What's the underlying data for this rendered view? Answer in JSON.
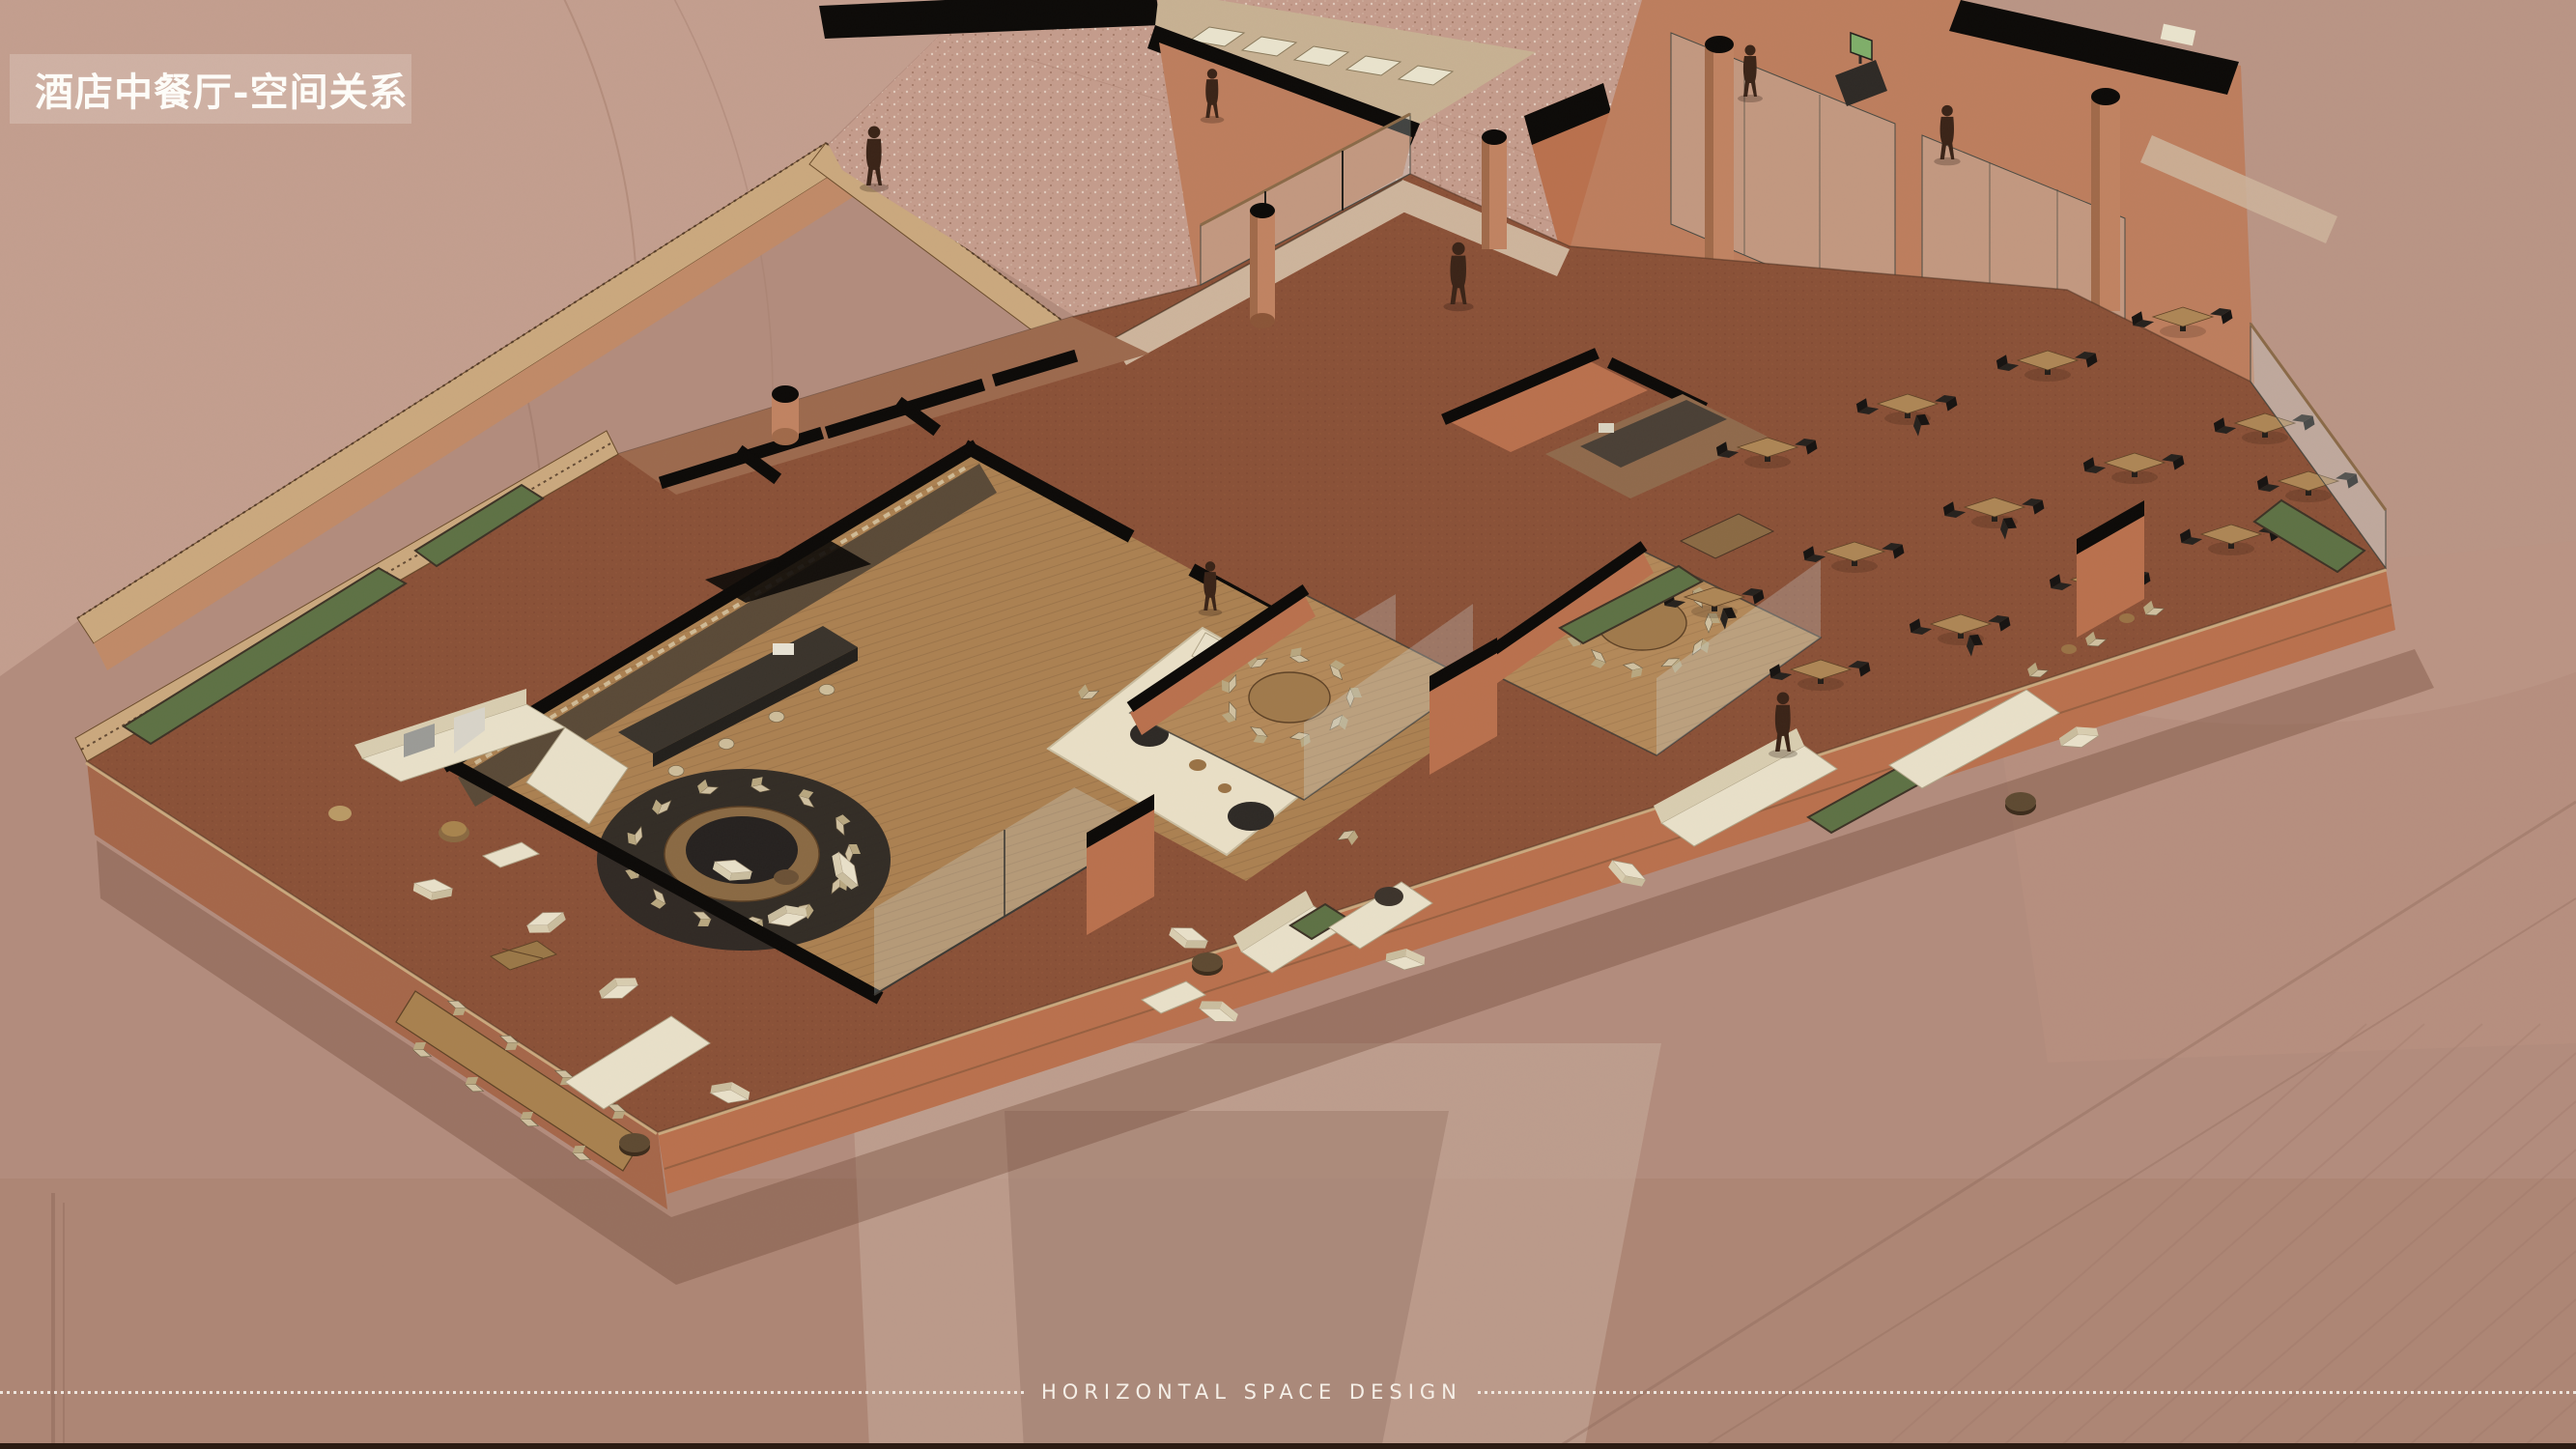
{
  "slide": {
    "title": "酒店中餐厅-空间关系",
    "footer": "HORIZONTAL SPACE DESIGN"
  },
  "colors": {
    "background": "#b28c7d",
    "title_band": "rgba(242,231,223,0.26)",
    "title_text": "#fdfcf8",
    "footer_text": "#f5efe7",
    "terracotta_wall": "#bd7e5e",
    "brick_wall": "#b9714e",
    "cut_wall": "#0c0a08",
    "carpet": "#8a5138",
    "wood_floor": "#ab8152",
    "wood_coping": "#caa87e",
    "cream": "#e8e0c9",
    "planter_green": "#5e7245",
    "courtyard_paving": "#c49c8c",
    "glass": "rgba(210,220,218,0.28)",
    "figure": "#3a2418"
  }
}
